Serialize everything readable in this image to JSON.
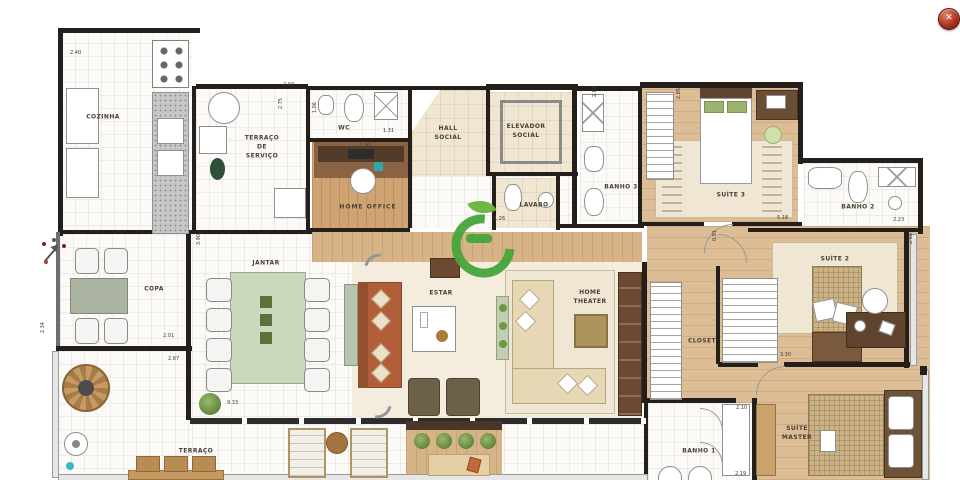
{
  "window": {
    "close_glyph": "✕"
  },
  "palette": {
    "wall": "#241f1b",
    "wood_floor": "#ddbd95",
    "tile_floor": "#fbfaf6",
    "beige_tile": "#f1e6d1",
    "rust_sofa": "#b05f38",
    "sage_table": "#ccd8bd",
    "watermark_green": "#47a63b",
    "close_button_red": "#a72a18"
  },
  "plan": {
    "rooms": [
      {
        "id": "cozinha",
        "label": "COZINHA"
      },
      {
        "id": "terraco-servico",
        "label": "TERRAÇO\nDE\nSERVIÇO"
      },
      {
        "id": "wc",
        "label": "WC"
      },
      {
        "id": "home-office",
        "label": "HOME OFFICE"
      },
      {
        "id": "hall-social",
        "label": "HALL\nSOCIAL"
      },
      {
        "id": "elevador-social",
        "label": "ELEVADOR\nSOCIAL"
      },
      {
        "id": "lavabo",
        "label": "LAVABO"
      },
      {
        "id": "banho-3",
        "label": "BANHO 3"
      },
      {
        "id": "suite-3",
        "label": "SUÍTE 3"
      },
      {
        "id": "banho-2",
        "label": "BANHO 2"
      },
      {
        "id": "suite-2",
        "label": "SUÍTE 2"
      },
      {
        "id": "closet",
        "label": "CLOSET"
      },
      {
        "id": "jantar",
        "label": "JANTAR"
      },
      {
        "id": "estar",
        "label": "ESTAR"
      },
      {
        "id": "home-theater",
        "label": "HOME\nTHEATER"
      },
      {
        "id": "copa",
        "label": "COPA"
      },
      {
        "id": "terraco",
        "label": "TERRAÇO"
      },
      {
        "id": "suite-master",
        "label": "SUÍTE\nMASTER"
      },
      {
        "id": "banho-1",
        "label": "BANHO 1"
      }
    ],
    "dimensions": [
      {
        "text": "2.40"
      },
      {
        "text": "2.03"
      },
      {
        "text": "2.75"
      },
      {
        "text": "1.06"
      },
      {
        "text": "1.31"
      },
      {
        "text": "1.93"
      },
      {
        "text": "2.83"
      },
      {
        "text": "2.85"
      },
      {
        "text": "5.18"
      },
      {
        "text": "0.91"
      },
      {
        "text": "2.23"
      },
      {
        "text": "2.68"
      },
      {
        "text": "3.30"
      },
      {
        "text": "2.10"
      },
      {
        "text": "2.19"
      },
      {
        "text": "3.90"
      },
      {
        "text": "9.33"
      },
      {
        "text": "2.34"
      },
      {
        "text": "2.01"
      },
      {
        "text": "2.87"
      },
      {
        "text": "1.26"
      }
    ]
  }
}
